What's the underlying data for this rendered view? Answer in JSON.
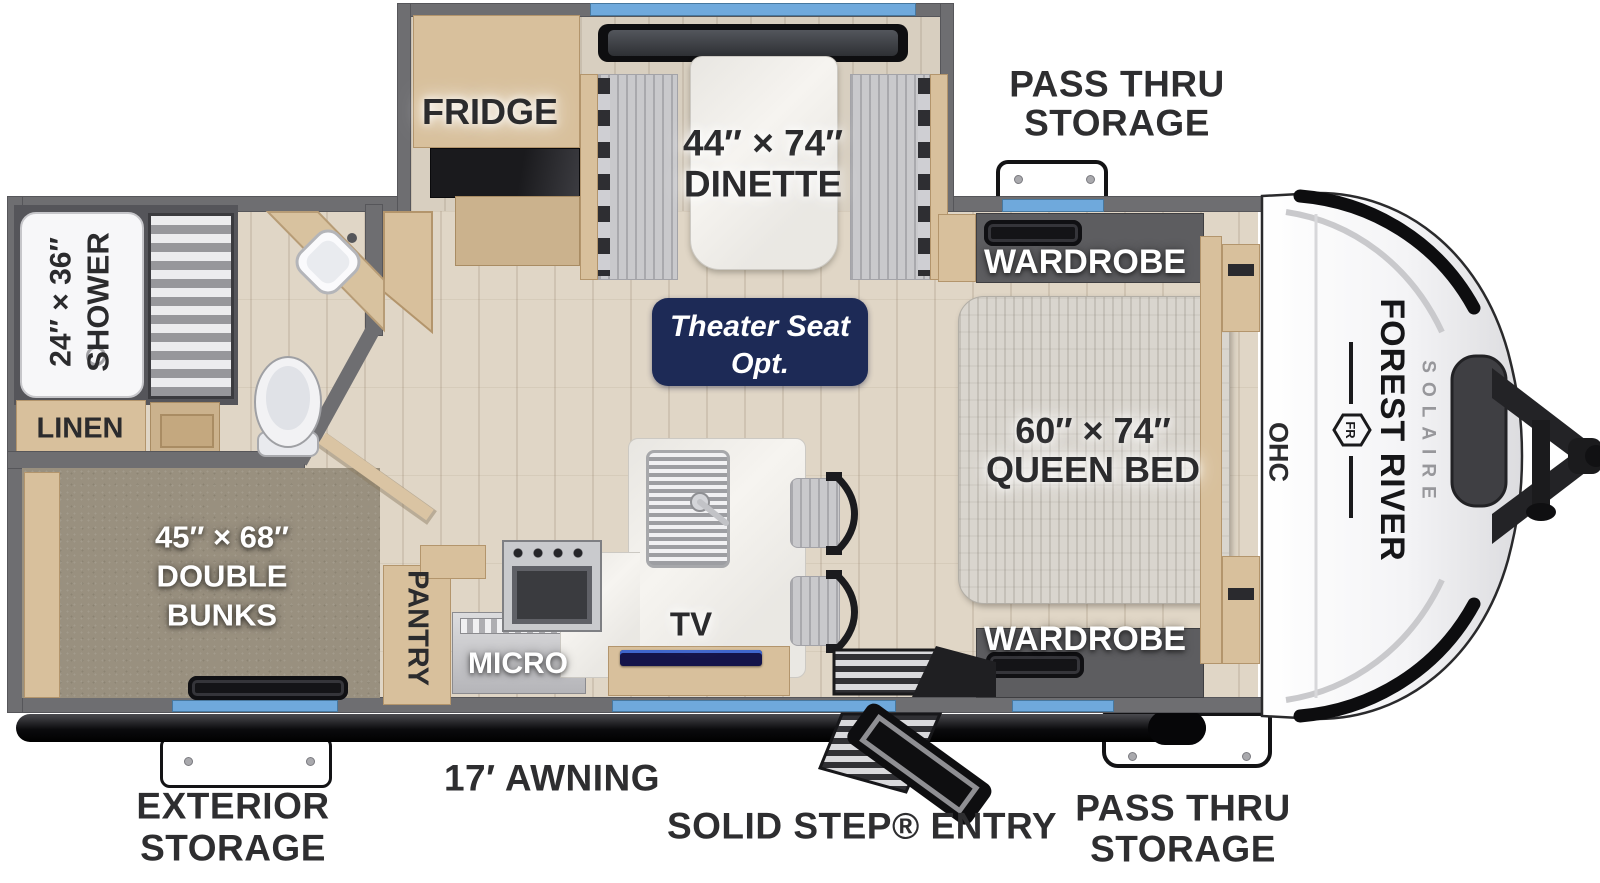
{
  "title": "Forest River Solaire Travel Trailer Floor Plan",
  "colors": {
    "window_accent": "#6FA9DC",
    "badge_navy": "#1D2A56",
    "wall_gray": "#6E6E71",
    "floor_wood": "#E0D6C6",
    "carpet_taupe": "#99907F",
    "cabinet_wood": "#D8C09C",
    "awning_black": "#111113"
  },
  "branding": {
    "make": "FOREST RIVER",
    "model": "SOLAIRE",
    "emblem_initials": "FR"
  },
  "labels": {
    "fridge": "FRIDGE",
    "dinette_size": "44″ × 74″",
    "dinette": "DINETTE",
    "theater_line1": "Theater Seat",
    "theater_line2": "Opt.",
    "pass_thru_line1": "PASS THRU",
    "pass_thru_line2": "STORAGE",
    "wardrobe": "WARDROBE",
    "queen_size": "60″ × 74″",
    "queen": "QUEEN BED",
    "ohc": "OHC",
    "shower_size": "24″ × 36″",
    "shower": "SHOWER",
    "linen": "LINEN",
    "bunks_size": "45″ × 68″",
    "bunks_line2": "DOUBLE",
    "bunks_line3": "BUNKS",
    "pantry": "PANTRY",
    "micro": "MICRO",
    "tv": "TV",
    "exterior_line1": "EXTERIOR",
    "exterior_line2": "STORAGE",
    "awning": "17′ AWNING",
    "entry": "SOLID STEP® ENTRY"
  }
}
